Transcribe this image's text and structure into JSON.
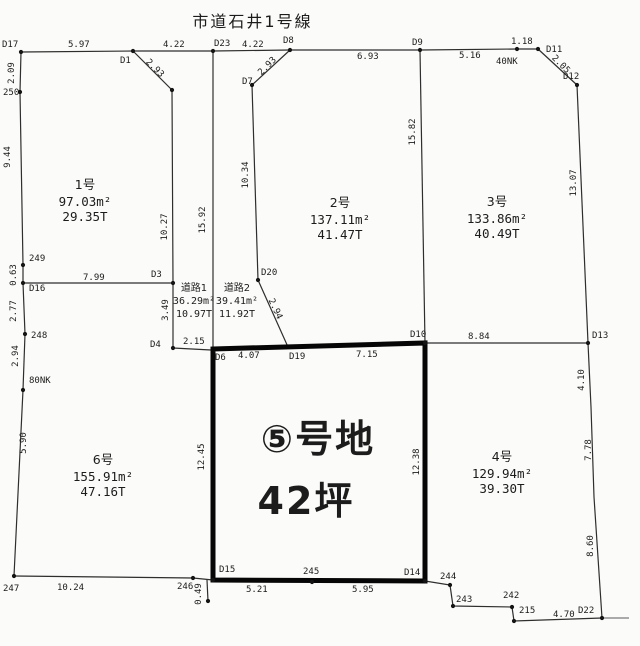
{
  "title": "市道石井1号線",
  "highlight": {
    "name": "⑤号地",
    "tsubo": "42坪",
    "name_x": 318,
    "name_y": 452,
    "tsubo_x": 306,
    "tsubo_y": 514
  },
  "plots": [
    {
      "name": "1号",
      "area": "97.03m²",
      "tsubo": "29.35T",
      "cx": 85,
      "cy": 189
    },
    {
      "name": "2号",
      "area": "137.11m²",
      "tsubo": "41.47T",
      "cx": 340,
      "cy": 207
    },
    {
      "name": "3号",
      "area": "133.86m²",
      "tsubo": "40.49T",
      "cx": 497,
      "cy": 206
    },
    {
      "name": "4号",
      "area": "129.94m²",
      "tsubo": "39.30T",
      "cx": 502,
      "cy": 461
    },
    {
      "name": "6号",
      "area": "155.91m²",
      "tsubo": "47.16T",
      "cx": 103,
      "cy": 464
    }
  ],
  "roads": [
    {
      "name": "道路1",
      "area": "36.29m²",
      "tsubo": "10.97T",
      "cx": 194,
      "cy": 291
    },
    {
      "name": "道路2",
      "area": "39.41m²",
      "tsubo": "11.92T",
      "cx": 237,
      "cy": 291
    }
  ],
  "labels": [
    {
      "t": "D17",
      "x": 2,
      "y": 47
    },
    {
      "t": "5.97",
      "x": 68,
      "y": 47
    },
    {
      "t": "D1",
      "x": 120,
      "y": 63
    },
    {
      "t": "4.22",
      "x": 163,
      "y": 47
    },
    {
      "t": "D23",
      "x": 214,
      "y": 46
    },
    {
      "t": "4.22",
      "x": 242,
      "y": 47
    },
    {
      "t": "D8",
      "x": 283,
      "y": 43
    },
    {
      "t": "D7",
      "x": 242,
      "y": 84
    },
    {
      "t": "6.93",
      "x": 357,
      "y": 59
    },
    {
      "t": "D9",
      "x": 412,
      "y": 45
    },
    {
      "t": "5.16",
      "x": 459,
      "y": 58
    },
    {
      "t": "40NK",
      "x": 496,
      "y": 64
    },
    {
      "t": "1.18",
      "x": 511,
      "y": 44
    },
    {
      "t": "D11",
      "x": 546,
      "y": 52
    },
    {
      "t": "D12",
      "x": 563,
      "y": 79
    },
    {
      "t": "250",
      "x": 3,
      "y": 95
    },
    {
      "t": "249",
      "x": 29,
      "y": 261
    },
    {
      "t": "D16",
      "x": 29,
      "y": 291
    },
    {
      "t": "7.99",
      "x": 83,
      "y": 280
    },
    {
      "t": "248",
      "x": 31,
      "y": 338
    },
    {
      "t": "80NK",
      "x": 29,
      "y": 383
    },
    {
      "t": "247",
      "x": 3,
      "y": 591
    },
    {
      "t": "10.24",
      "x": 57,
      "y": 590
    },
    {
      "t": "246",
      "x": 177,
      "y": 589
    },
    {
      "t": "D15",
      "x": 219,
      "y": 572
    },
    {
      "t": "245",
      "x": 303,
      "y": 574
    },
    {
      "t": "5.21",
      "x": 246,
      "y": 592
    },
    {
      "t": "5.95",
      "x": 352,
      "y": 592
    },
    {
      "t": "D14",
      "x": 404,
      "y": 575
    },
    {
      "t": "244",
      "x": 440,
      "y": 579
    },
    {
      "t": "243",
      "x": 456,
      "y": 602
    },
    {
      "t": "242",
      "x": 503,
      "y": 598
    },
    {
      "t": "215",
      "x": 519,
      "y": 613
    },
    {
      "t": "4.70",
      "x": 553,
      "y": 617
    },
    {
      "t": "D22",
      "x": 578,
      "y": 613
    },
    {
      "t": "D3",
      "x": 151,
      "y": 277
    },
    {
      "t": "D4",
      "x": 150,
      "y": 347
    },
    {
      "t": "2.15",
      "x": 183,
      "y": 344
    },
    {
      "t": "D20",
      "x": 261,
      "y": 275
    },
    {
      "t": "D10",
      "x": 410,
      "y": 337
    },
    {
      "t": "8.84",
      "x": 468,
      "y": 339
    },
    {
      "t": "D13",
      "x": 592,
      "y": 338
    },
    {
      "t": "D6",
      "x": 215,
      "y": 360
    },
    {
      "t": "4.07",
      "x": 238,
      "y": 358
    },
    {
      "t": "D19",
      "x": 289,
      "y": 359
    },
    {
      "t": "7.15",
      "x": 356,
      "y": 357
    },
    {
      "t": "2.09",
      "x": 14,
      "y": 73,
      "r": -90
    },
    {
      "t": "9.44",
      "x": 10,
      "y": 157,
      "r": -90
    },
    {
      "t": "0.63",
      "x": 16,
      "y": 275,
      "r": -90
    },
    {
      "t": "2.77",
      "x": 16,
      "y": 311,
      "r": -90
    },
    {
      "t": "2.94",
      "x": 18,
      "y": 356,
      "r": -90
    },
    {
      "t": "5.90",
      "x": 26,
      "y": 443,
      "r": -90
    },
    {
      "t": "10.27",
      "x": 167,
      "y": 227,
      "r": -90
    },
    {
      "t": "3.49",
      "x": 168,
      "y": 310,
      "r": -90
    },
    {
      "t": "15.92",
      "x": 205,
      "y": 220,
      "r": -90
    },
    {
      "t": "10.34",
      "x": 248,
      "y": 175,
      "r": -90
    },
    {
      "t": "15.82",
      "x": 415,
      "y": 132,
      "r": -90
    },
    {
      "t": "13.07",
      "x": 576,
      "y": 183,
      "r": -90
    },
    {
      "t": "4.10",
      "x": 584,
      "y": 380,
      "r": -90
    },
    {
      "t": "7.78",
      "x": 591,
      "y": 450,
      "r": -90
    },
    {
      "t": "8.60",
      "x": 593,
      "y": 546,
      "r": -90
    },
    {
      "t": "12.45",
      "x": 204,
      "y": 457,
      "r": -90
    },
    {
      "t": "12.38",
      "x": 419,
      "y": 462,
      "r": -90
    },
    {
      "t": "0.49",
      "x": 201,
      "y": 594,
      "r": -90
    },
    {
      "t": "2.93",
      "x": 153,
      "y": 70,
      "r": 45
    },
    {
      "t": "2.93",
      "x": 269,
      "y": 68,
      "r": -45
    },
    {
      "t": "2.05",
      "x": 559,
      "y": 66,
      "r": 45
    },
    {
      "t": "2.94",
      "x": 273,
      "y": 310,
      "r": 65
    }
  ],
  "points": [
    {
      "x": 21,
      "y": 52
    },
    {
      "x": 133,
      "y": 51
    },
    {
      "x": 172,
      "y": 90
    },
    {
      "x": 213,
      "y": 51
    },
    {
      "x": 252,
      "y": 85
    },
    {
      "x": 290,
      "y": 50
    },
    {
      "x": 420,
      "y": 50
    },
    {
      "x": 517,
      "y": 49
    },
    {
      "x": 538,
      "y": 49
    },
    {
      "x": 577,
      "y": 85
    },
    {
      "x": 20,
      "y": 92
    },
    {
      "x": 23,
      "y": 265
    },
    {
      "x": 23,
      "y": 283
    },
    {
      "x": 25,
      "y": 334
    },
    {
      "x": 23,
      "y": 390
    },
    {
      "x": 14,
      "y": 576
    },
    {
      "x": 173,
      "y": 283
    },
    {
      "x": 173,
      "y": 348
    },
    {
      "x": 258,
      "y": 280
    },
    {
      "x": 425,
      "y": 343
    },
    {
      "x": 588,
      "y": 343
    },
    {
      "x": 193,
      "y": 578
    },
    {
      "x": 213,
      "y": 580
    },
    {
      "x": 312,
      "y": 582
    },
    {
      "x": 425,
      "y": 581
    },
    {
      "x": 450,
      "y": 585
    },
    {
      "x": 453,
      "y": 606
    },
    {
      "x": 512,
      "y": 607
    },
    {
      "x": 514,
      "y": 621
    },
    {
      "x": 602,
      "y": 618
    },
    {
      "x": 208,
      "y": 601
    }
  ]
}
